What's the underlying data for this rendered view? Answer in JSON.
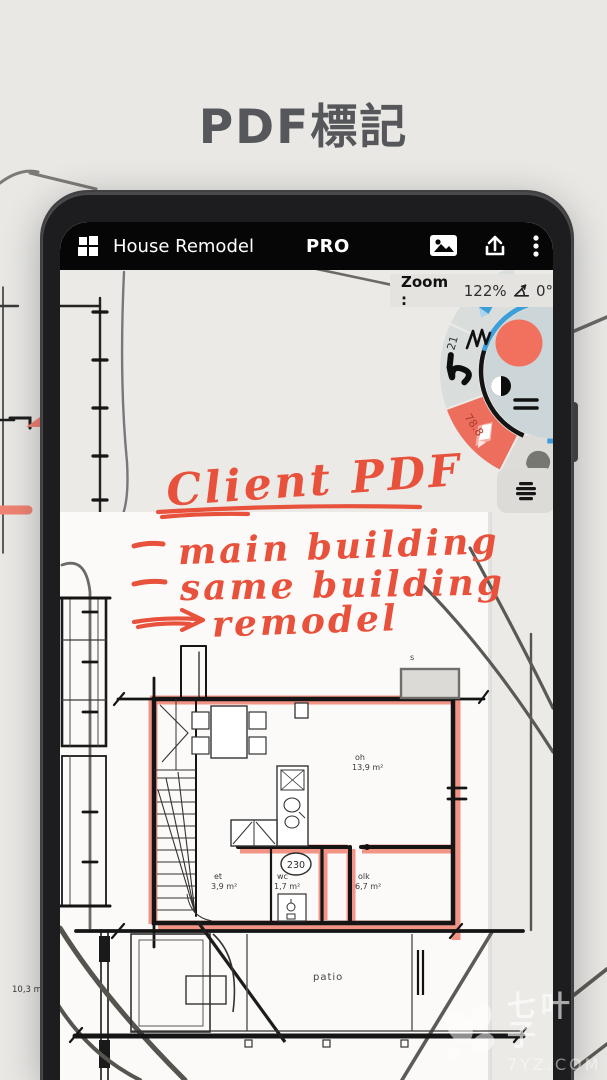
{
  "page": {
    "title": "PDF標記"
  },
  "app_bar": {
    "title": "House Remodel",
    "badge": "PRO",
    "icons": [
      "grid-menu-icon",
      "image-icon",
      "share-icon",
      "overflow-menu-icon"
    ]
  },
  "zoom_bar": {
    "label": "Zoom :",
    "zoom_value": "122%",
    "angle_icon": "angle-icon",
    "angle_value": "0°"
  },
  "palette": {
    "selected_color": "#F1705E",
    "inner_icons": [
      "pen-scribble-icon",
      "contrast-icon",
      "equals-icon"
    ],
    "tools": [
      {
        "label": "78.8",
        "type": "highlighter",
        "selected": false
      },
      {
        "label": "21",
        "type": "brush",
        "selected": false
      },
      {
        "label": "78.8",
        "type": "marker",
        "selected": true
      },
      {
        "label": "8.4",
        "type": "eraser",
        "selected": false
      }
    ]
  },
  "layers_button": {
    "icon": "layers-icon"
  },
  "annotations": {
    "heading": "Client PDF",
    "items": [
      "main building",
      "same building",
      "remodel"
    ]
  },
  "floorplan": {
    "rooms": [
      {
        "abbr": "oh",
        "area": "13,9 m²"
      },
      {
        "abbr": "et",
        "area": "3,9 m²"
      },
      {
        "abbr": "wc",
        "area": "1,7 m²"
      },
      {
        "abbr": "olk",
        "area": "6,7 m²"
      }
    ],
    "labels": {
      "patio": "patio",
      "door_width": "230",
      "sauna": "s"
    }
  },
  "background": {
    "area_label": "10,3 m²"
  },
  "watermark": {
    "name": "七叶子",
    "site": "7YZ.COM"
  },
  "colors": {
    "marker_red": "#E8523D",
    "highlight_red": "#F08373",
    "accent_blue": "#3E9ED7",
    "toolbar_bg": "#060606",
    "paper": "#E9E8E5",
    "page_white": "#FBFAF8"
  }
}
